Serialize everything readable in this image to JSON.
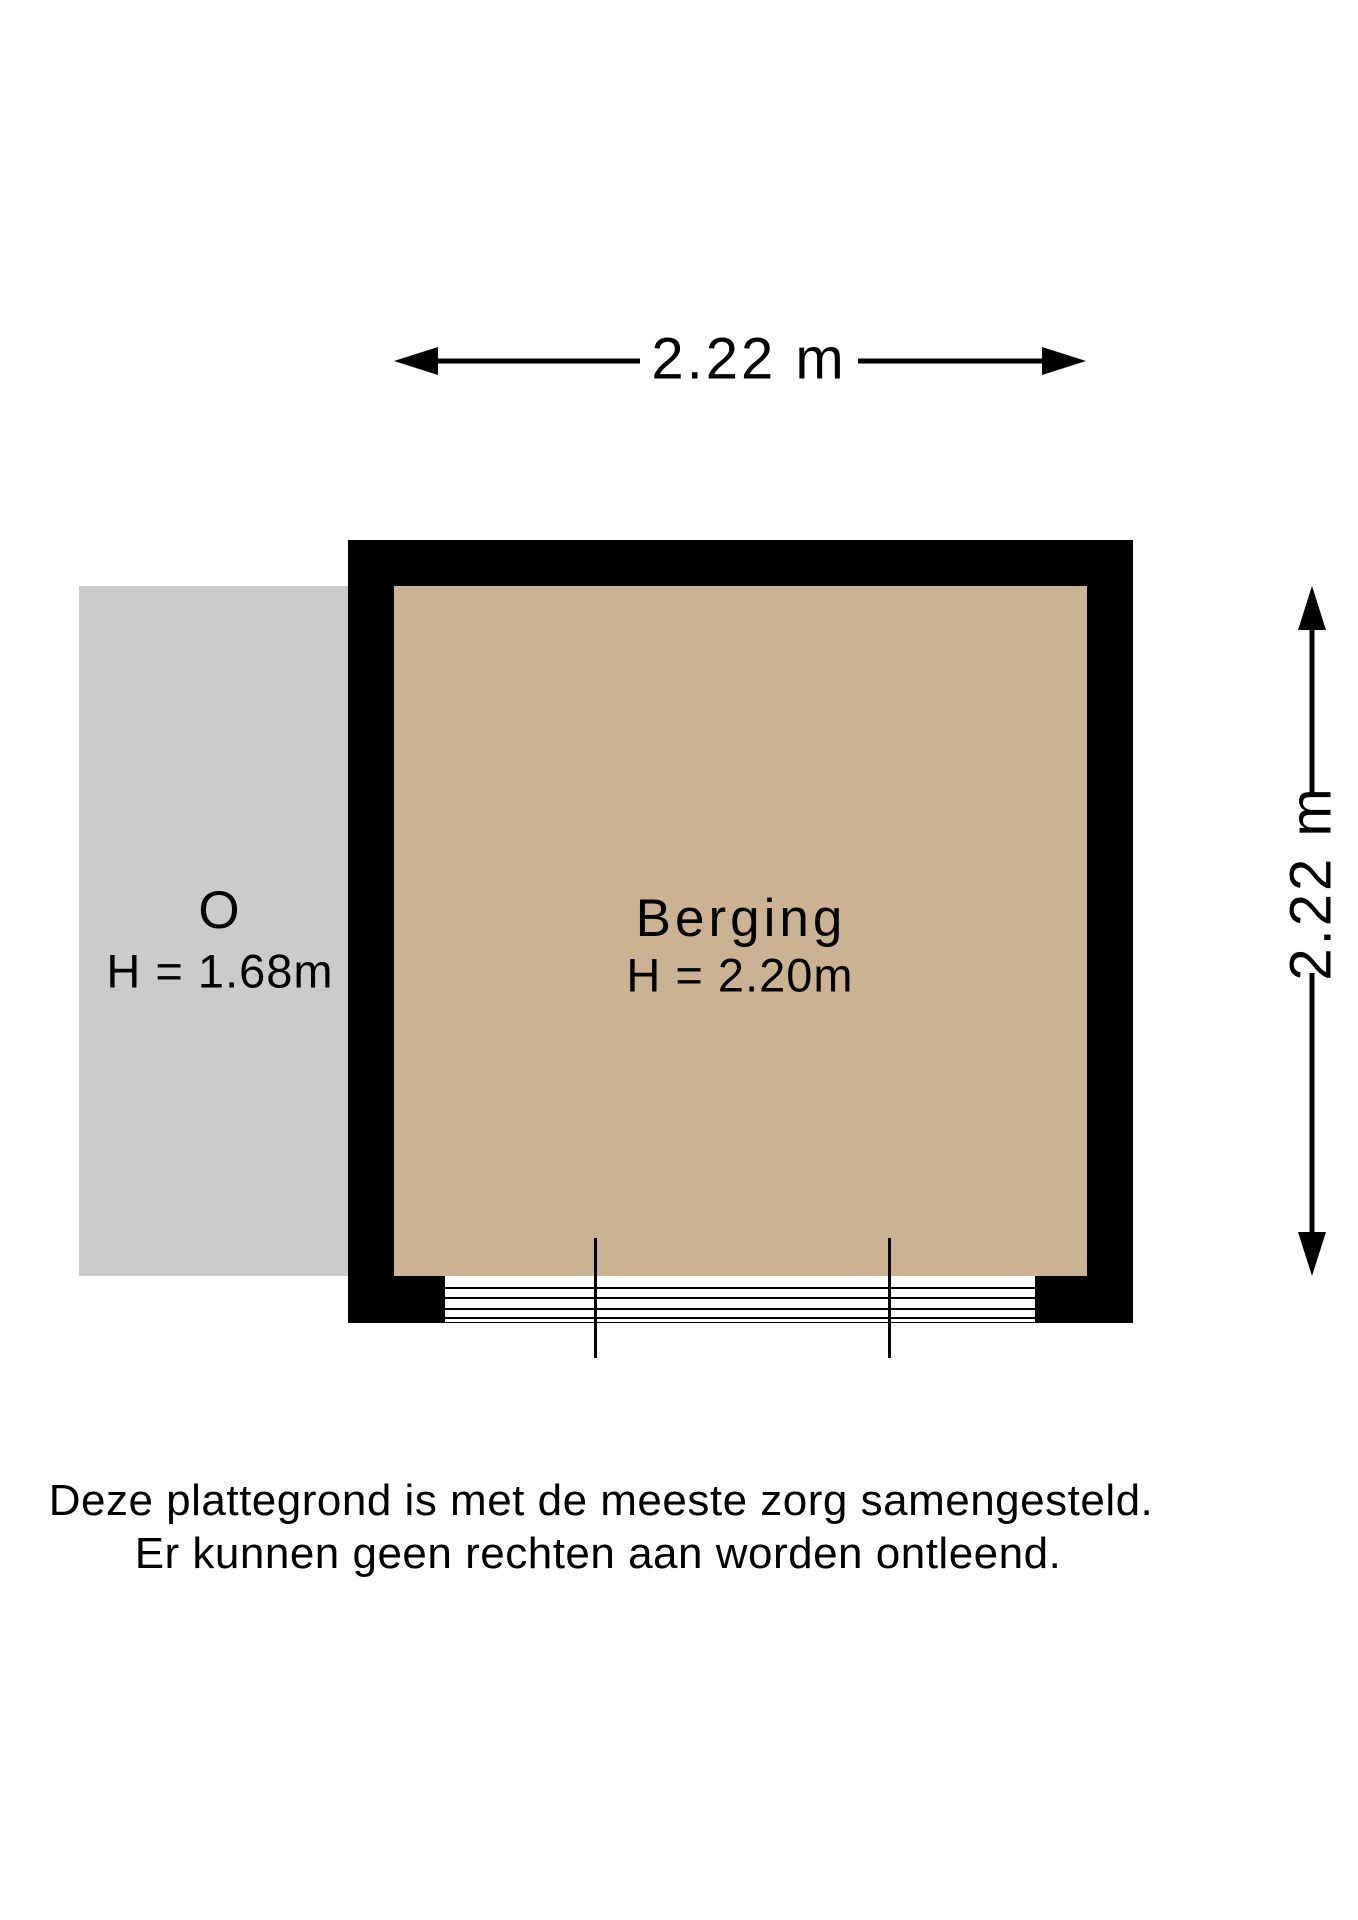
{
  "floorplan": {
    "width_dimension": "2.22 m",
    "height_dimension": "2.22 m",
    "room": {
      "name": "Berging",
      "ceiling_height": "H = 2.20m"
    },
    "annex": {
      "name": "O",
      "ceiling_height": "H = 1.68m"
    }
  },
  "disclaimer": {
    "line1": "Deze plattegrond is met de meeste zorg samengesteld.",
    "line2": "Er kunnen geen rechten aan worden ontleend."
  },
  "colors": {
    "background": "#ffffff",
    "wall": "#000000",
    "room_floor": "#cab292",
    "annex_fill": "#cbcbcb",
    "line": "#000000",
    "text": "#000000"
  }
}
